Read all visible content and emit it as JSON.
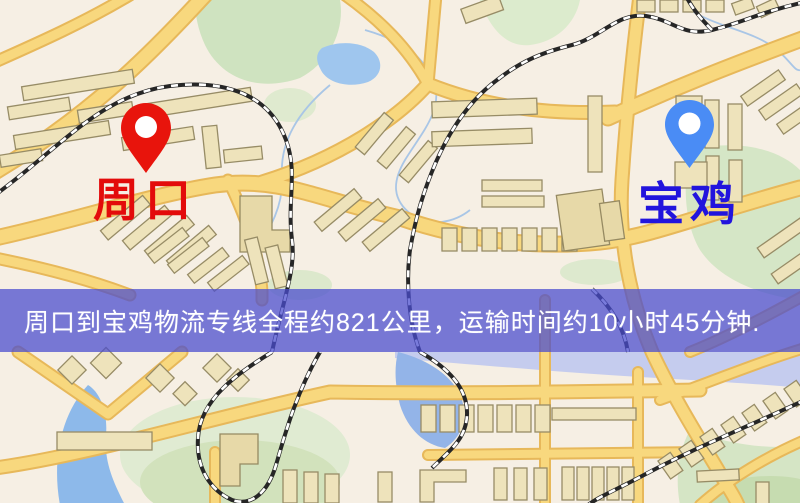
{
  "map": {
    "origin": {
      "name": "周口",
      "marker_color": "#e8140c",
      "label_color": "#e30b0b"
    },
    "destination": {
      "name": "宝鸡",
      "marker_color": "#4a8cf5",
      "label_color": "#2214dd"
    },
    "banner": {
      "text": "周口到宝鸡物流专线全程约821公里，运输时间约10小时45分钟.",
      "background": "#4a4dce",
      "text_color": "#ffffff"
    },
    "route": {
      "distance": "821公里",
      "duration": "10小时45分钟"
    }
  }
}
